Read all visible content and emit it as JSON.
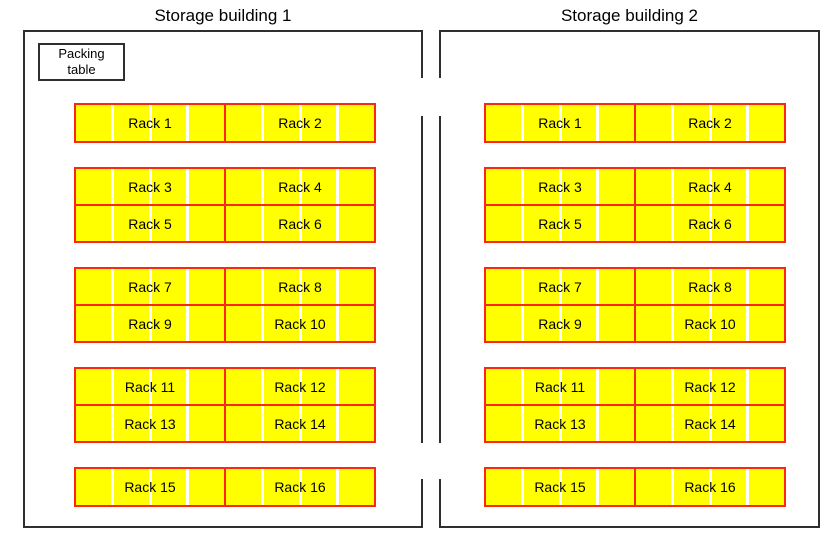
{
  "diagram_title": "Warehouse storage layout",
  "segments_per_rack": 4,
  "colors": {
    "rack_fill": "#ffff00",
    "rack_border": "#ff2610",
    "wall": "#2f2f2f",
    "text": "#000000",
    "background": "#ffffff"
  },
  "buildings": [
    {
      "title": "Storage building 1",
      "packing_table_lines": [
        "Packing",
        "table"
      ],
      "racks": [
        "Rack 1",
        "Rack 2",
        "Rack 3",
        "Rack 4",
        "Rack 5",
        "Rack 6",
        "Rack 7",
        "Rack 8",
        "Rack 9",
        "Rack 10",
        "Rack 11",
        "Rack 12",
        "Rack 13",
        "Rack 14",
        "Rack 15",
        "Rack 16"
      ]
    },
    {
      "title": "Storage building 2",
      "racks": [
        "Rack 1",
        "Rack 2",
        "Rack 3",
        "Rack 4",
        "Rack 5",
        "Rack 6",
        "Rack 7",
        "Rack 8",
        "Rack 9",
        "Rack 10",
        "Rack 11",
        "Rack 12",
        "Rack 13",
        "Rack 14",
        "Rack 15",
        "Rack 16"
      ]
    }
  ]
}
